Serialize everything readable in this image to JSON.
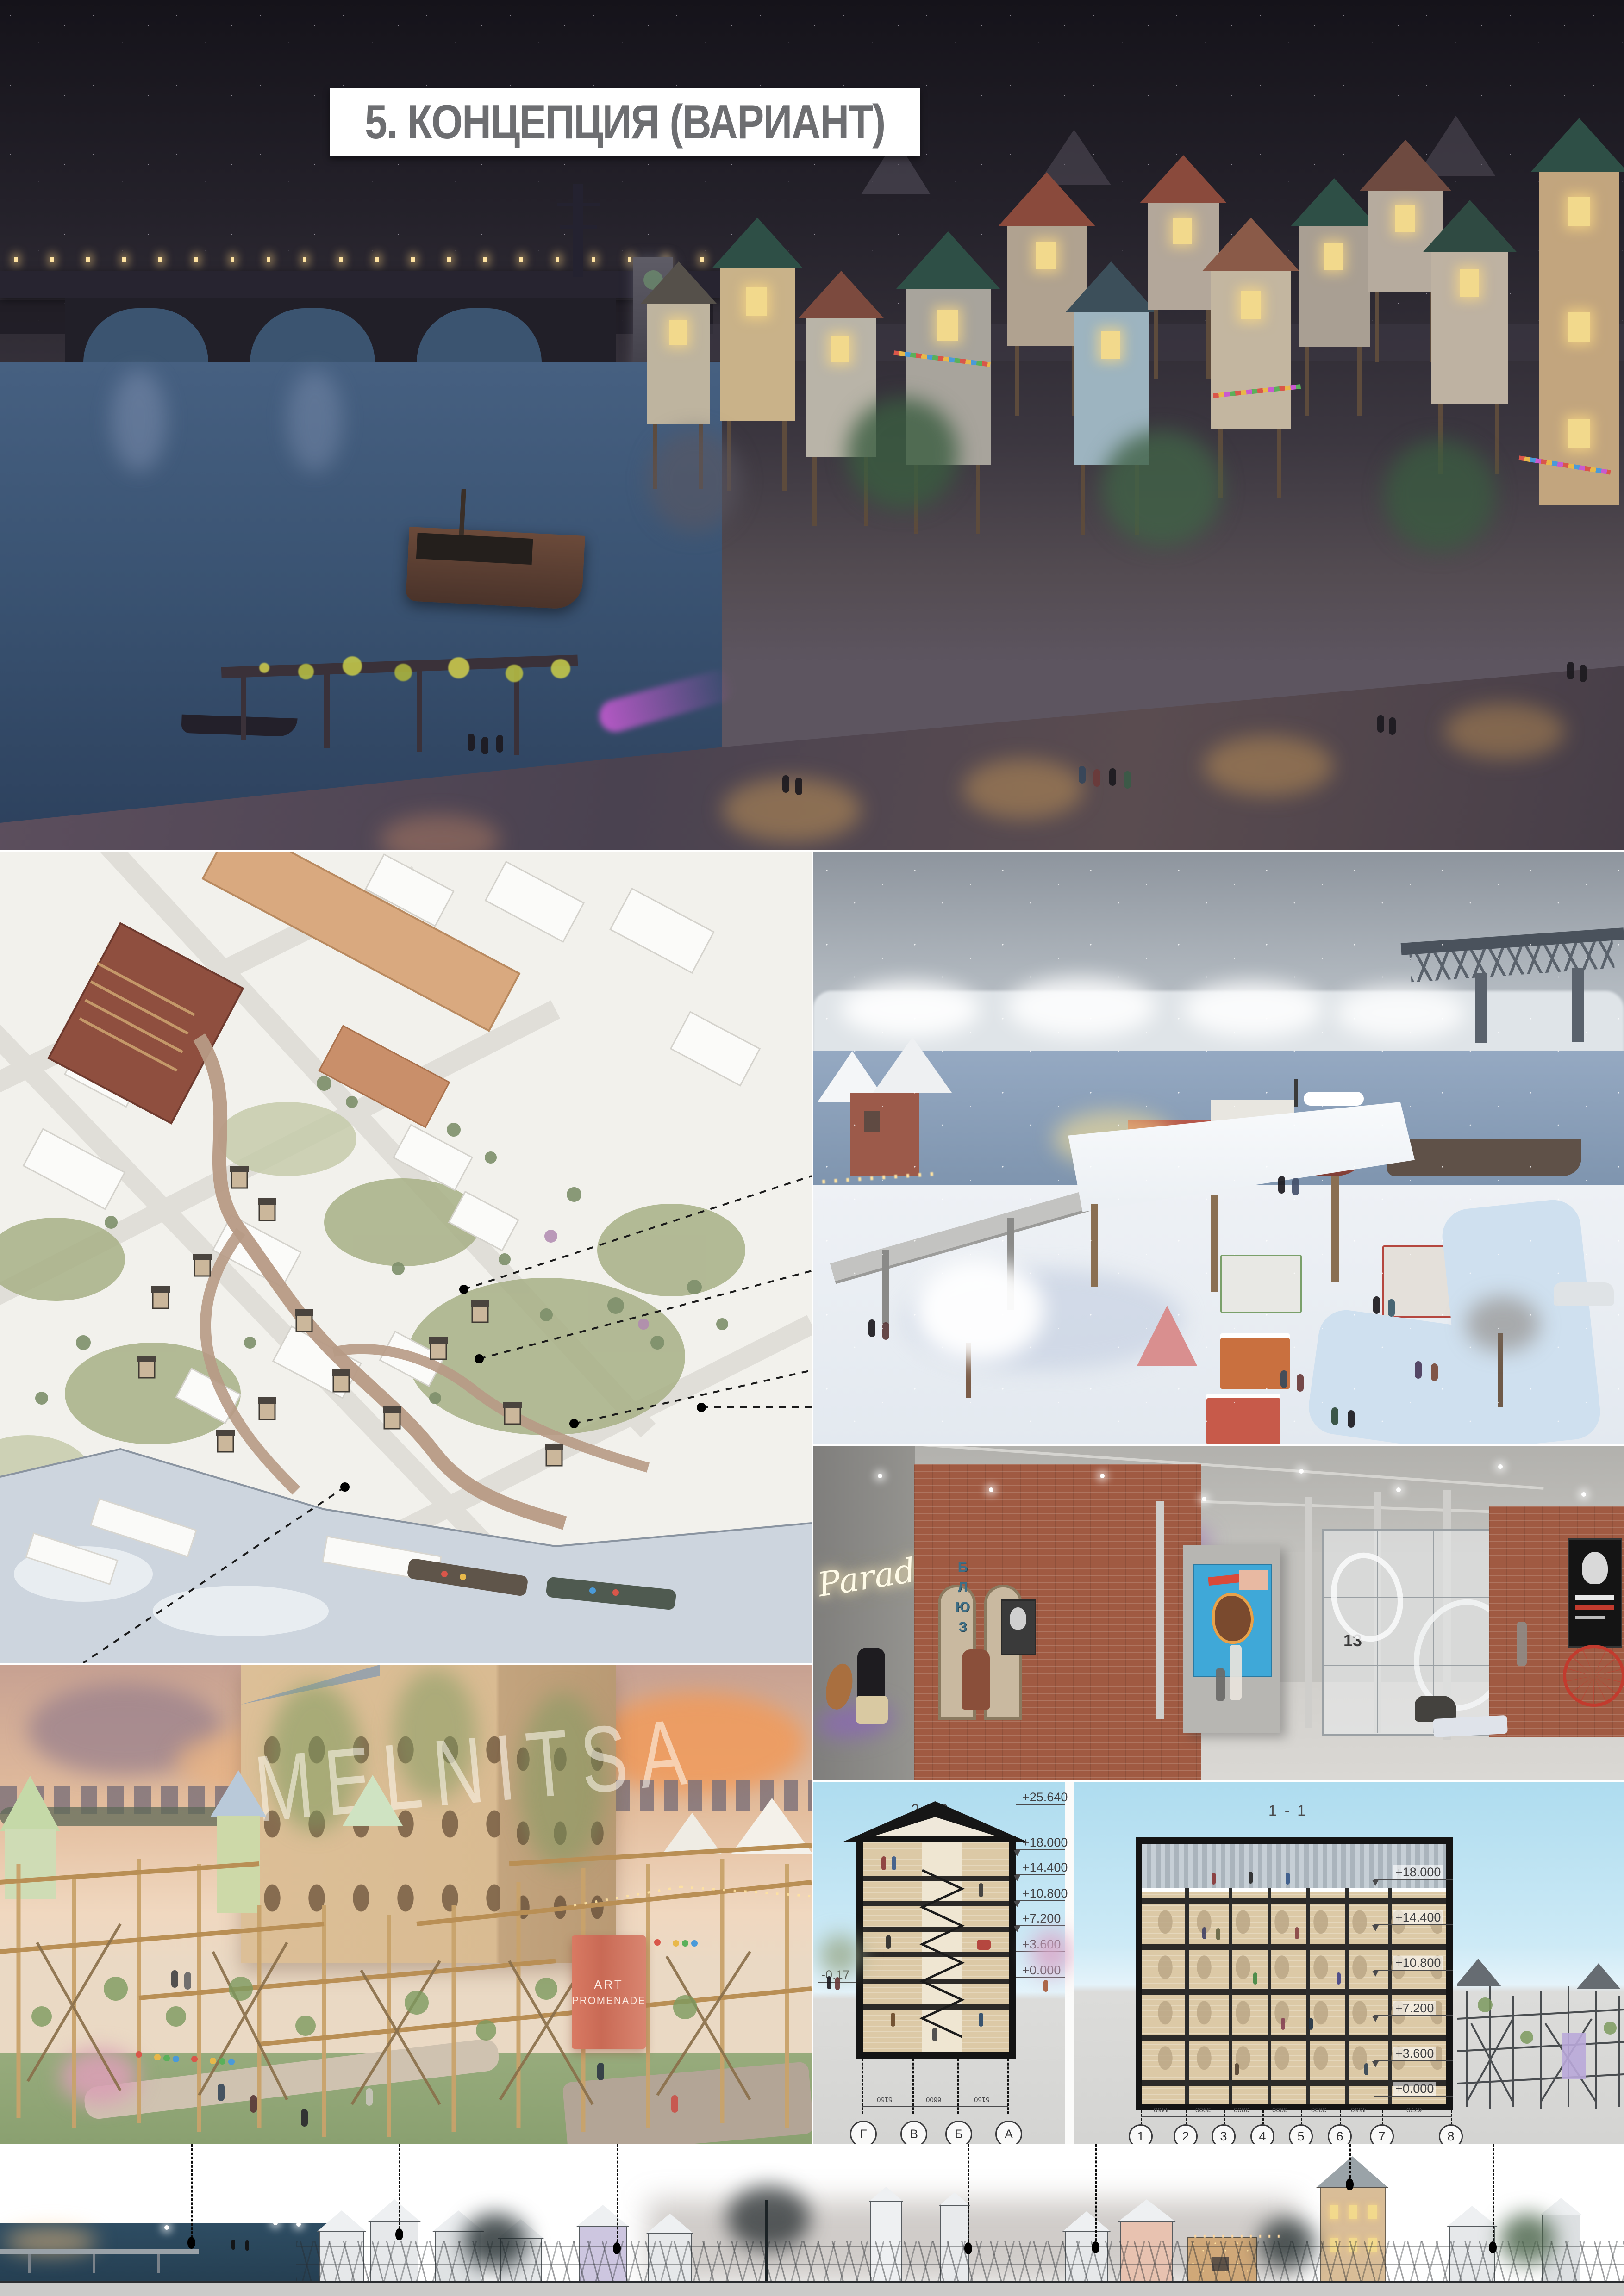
{
  "title": "5. КОНЦЕПЦИЯ (ВАРИАНТ)",
  "gallery": {
    "neon_sign": "Paradise",
    "vertical_sign": "БЛЮЗ",
    "partition_number": "13"
  },
  "mill": {
    "facade_sign": "MELNITSA",
    "banner_line1": "ART",
    "banner_line2": "PROMENADE"
  },
  "sections": {
    "left": {
      "label": "2 - 2",
      "elevations": [
        "+25.640",
        "+18.000",
        "+14.400",
        "+10.800",
        "+7.200",
        "+3.600",
        "+0.000"
      ],
      "ground_mark": "-0.17",
      "grid": [
        "Г",
        "В",
        "Б",
        "А"
      ],
      "dims": [
        "5150",
        "6600",
        "5150"
      ]
    },
    "right": {
      "label": "1 - 1",
      "elevations": [
        "+18.000",
        "+14.400",
        "+10.800",
        "+7.200",
        "+3.600",
        "+0.000"
      ],
      "grid": [
        "1",
        "2",
        "3",
        "4",
        "5",
        "6",
        "7",
        "8"
      ],
      "dims": [
        "4450",
        "3900",
        "3900",
        "3900",
        "3900",
        "4550",
        "6770"
      ]
    }
  },
  "colors": {
    "window_glow": "#f2d98c",
    "brick": "#a05a42",
    "section_frame": "#141414",
    "day_sky": "#b5e0f0",
    "banner": "#d97a63",
    "neon": "#fff8dd",
    "night_sky": "#15131a"
  }
}
